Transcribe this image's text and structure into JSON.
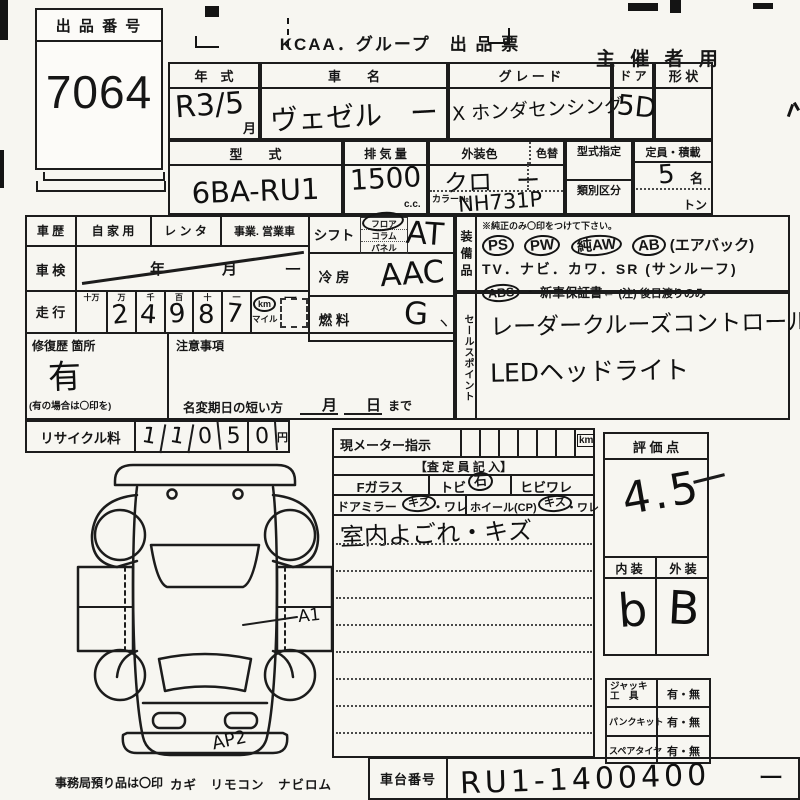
{
  "ticket": {
    "label": "出 品 番 号",
    "number": "7064"
  },
  "header": {
    "title": "KCAA．グループ　出 品 票",
    "organizer": "主 催 者 用"
  },
  "top": {
    "year_label": "年　式",
    "year_value": "R3/5",
    "year_unit": "月",
    "name_label": "車　　名",
    "name_value": "ヴェゼル　ー",
    "grade_label": "グ レ ー ド",
    "grade_value": "X ホンダセンシング",
    "door_label": "ド ア",
    "door_value": "5D",
    "shape_label": "形 状",
    "model_label": "型　　式",
    "model_value": "6BA-RU1",
    "disp_label": "排 気 量",
    "disp_value": "1500",
    "disp_unit": "c.c.",
    "color_label": "外装色",
    "color_value": "クロ　ー",
    "recolor_label": "色替",
    "colorno_label": "カラー№",
    "colorno_value": "NH731P",
    "typedes_label": "型式指定",
    "classdiv_label": "類別区分",
    "capacity_label": "定員・積載",
    "capacity_value": "5",
    "capacity_unit": "名",
    "capacity_ton": "トン"
  },
  "left": {
    "history_label": "車 歴",
    "history_opt1": "自 家 用",
    "history_opt2": "レ ン タ",
    "history_opt3": "事業. 営業車",
    "inspection_label": "車 検",
    "inspection_year": "年",
    "inspection_month": "月",
    "inspection_mark": "ー",
    "mileage_label": "走 行",
    "digit_h0": "十万",
    "digit_h1": "万",
    "digit_h2": "千",
    "digit_h3": "百",
    "digit_h4": "十",
    "digit_h5": "一",
    "d1": "2",
    "d2": "4",
    "d3": "9",
    "d4": "8",
    "d5": "7",
    "unit_km": "km",
    "unit_mile": "マイル",
    "meter_mark": "ー",
    "repair_label": "修復歴 箇所",
    "repair_value": "有",
    "repair_note": "(有の場合は〇印を)",
    "caution_label": "注意事項",
    "namechange_label": "名変期日の短い方",
    "namechange_month": "月",
    "namechange_day": "日",
    "namechange_suffix": "まで",
    "recycle_label": "リサイクル料",
    "r1": "1",
    "r2": "1",
    "r3": "0",
    "r4": "5",
    "r5": "0",
    "recycle_unit": "円"
  },
  "spec": {
    "shift_label": "シフト",
    "shift_opt1": "フロア",
    "shift_opt2": "コラム",
    "shift_opt3": "パネル",
    "shift_value": "AT",
    "ac_label": "冷 房",
    "ac_value": "AAC",
    "fuel_label": "燃 料",
    "fuel_value": "G",
    "fuel_mark": "ヽ"
  },
  "equipment": {
    "side_label": "装備品",
    "note": "※純正のみ〇印をつけて下さい。",
    "ps": "PS",
    "pw": "PW",
    "aw": "純AW",
    "ab": "AB",
    "ab_suffix": "(エアバック)",
    "line2": "TV．ナビ．カワ．SR (サンルーフ)",
    "abs": "ABS",
    "warranty": "・ 新車保証書←",
    "warranty_note": "(注) 後日渡りのみ"
  },
  "sales": {
    "side_label": "セールスポイント",
    "point1": "レーダークルーズコントロール",
    "point2": "LEDヘッドライト"
  },
  "meter": {
    "label": "現メーター指示",
    "unit": "km",
    "assessor": "【査 定 員 記 入】",
    "glass_label": "Fガラス",
    "glass_chip": "トビ",
    "glass_chip_circled": "石",
    "glass_crack": "ヒビワレ",
    "mirror_label": "ドアミラー",
    "mirror_scratch": "キズ",
    "mirror_crack": "・ワレ",
    "wheel_label": "ホイール(CP)",
    "wheel_scratch": "キズ",
    "wheel_crack": "・ワレ",
    "note": "室内よごれ・キズ"
  },
  "evaluation": {
    "label": "評 価 点",
    "score": "4.5",
    "interior_label": "内 装",
    "exterior_label": "外 装",
    "interior_grade": "b",
    "exterior_grade": "B"
  },
  "tools": {
    "jack_label1": "ジャッキ",
    "jack_label2": "工　具",
    "jack_value": "有・無",
    "puncture_label": "パンクキット",
    "puncture_value": "有・無",
    "spare_label": "スペアタイヤ",
    "spare_value": "有・無"
  },
  "chassis": {
    "label": "車台番号",
    "value": "RU1-1400400",
    "mark": "ー"
  },
  "footer": {
    "note": "事務局預り品は〇印",
    "items": "カギ　リモコン　ナビロム"
  },
  "diagram": {
    "label_a1": "A1",
    "label_ap2": "AP2"
  }
}
